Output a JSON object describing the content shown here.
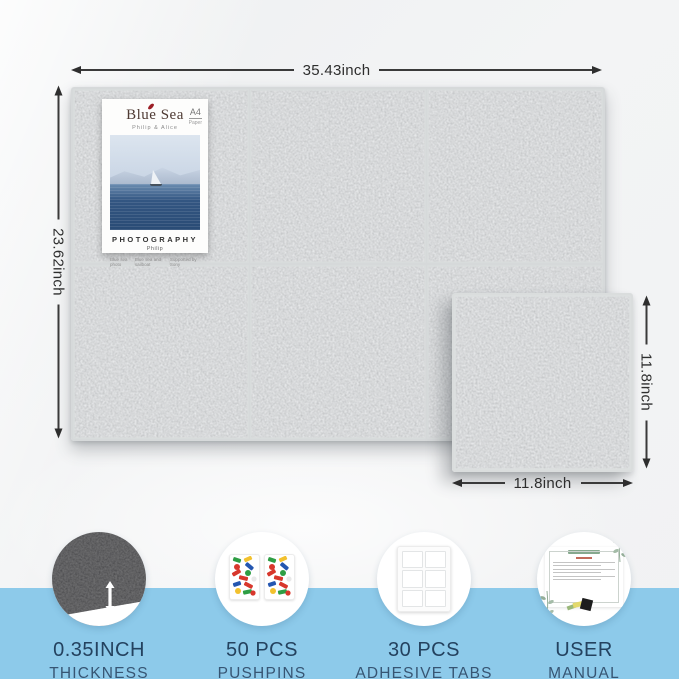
{
  "product_board": {
    "dimensions": {
      "board_width": "35.43inch",
      "board_height": "23.62inch",
      "tile_height": "11.8inch",
      "tile_width": "11.8inch"
    },
    "poster": {
      "title": "Blue Sea",
      "subtitle": "Philip & Alice",
      "paper_size": "A4",
      "paper_label": "Paper",
      "caption": "PHOTOGRAPHY",
      "author": "Philip",
      "footnote_separator": "|",
      "footnotes": [
        "Blue sea photo",
        "Blue sea and sailboat",
        "Supported by Sony"
      ]
    },
    "features": [
      {
        "icon": "black-felt-thickness-icon",
        "value": "0.35INCH",
        "label": "THICKNESS"
      },
      {
        "icon": "pushpin-boxes-icon",
        "value": "50 PCS",
        "label": "PUSHPINS"
      },
      {
        "icon": "adhesive-tab-sheet-icon",
        "value": "30 PCS",
        "label": "ADHESIVE TABS"
      },
      {
        "icon": "user-manual-icon",
        "value": "USER",
        "label": "MANUAL"
      }
    ],
    "colors": {
      "felt_gray": "#a9aeb2",
      "felt_seam": "#d6d9da",
      "felt_black": "#161616",
      "band_blue": "#8dcaea",
      "label_navy": "#24425f",
      "dimension_line": "#2e2e2e",
      "poster_title": "#4e3a33",
      "sea_blue": "#2e5180"
    }
  }
}
